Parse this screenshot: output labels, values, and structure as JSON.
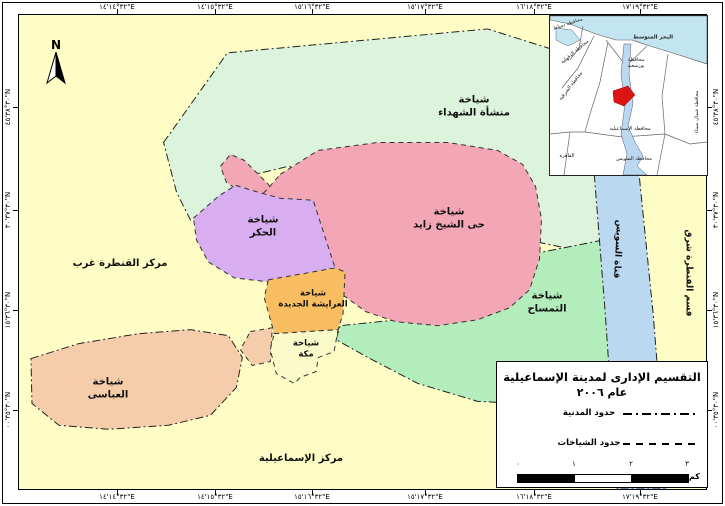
{
  "map_frame": {
    "north_label": "N",
    "coordinates": {
      "top": [
        "٣٢°١٤'١٤\"E",
        "٣٢°١٥'١٤\"E",
        "٣٢°١٦'١٥\"E",
        "٣٢°١٧'١٥\"E",
        "٣٢°١٨'١٦\"E",
        "٣٢°١٩'١٧\"E"
      ],
      "bottom": [
        "٣٢°١٤'١٤\"E",
        "٣٢°١٥'١٤\"E",
        "٣٢°١٦'١٥\"E",
        "٣٢°١٧'١٥\"E",
        "٣٢°١٨'١٦\"E",
        "٣٢°١٩'١٧\"E"
      ],
      "left": [
        "٣٠°٣٨'٤٥\"N",
        "٣٠°٣٧'٣٠\"N",
        "٣٠°٣٦'١٥\"N",
        "٣٠°٣٥'٠٠\"N"
      ],
      "right": [
        "٣٠°٣٨'٤٥\"N",
        "٣٠°٣٧'٣٠\"N",
        "٣٠°٣٦'١٥\"N",
        "٣٠°٣٥'٠٠\"N"
      ]
    }
  },
  "regions": {
    "manshaat_elshohada": "شياخة\nمنشأة الشهداء",
    "sheikh_zayed": "شياخة\nحى الشيخ زايد",
    "elhekr": "شياخة\nالحكر",
    "elaraysha_elgedida": "شياخة\nالعرايشة الجديدة",
    "mekka": "شياخة\nمكة",
    "eltemsah": "شياخة\nالتمساح",
    "elabbasi": "شياخة\nالعباسى",
    "qantara_gharb": "مركز القنطرة غرب",
    "markaz_ismailia": "مركز الإسماعيلية",
    "suez_canal": "قناة السويس",
    "qantara_sharq": "قسم القنطرة شرق"
  },
  "inset": {
    "mediterranean": "البحر المتوسط",
    "damietta": "محافظة دمياط",
    "dakahlia": "محافظة الدقهلية",
    "sharqia": "محافظة الشرقية",
    "port_said": "محافظة\nبورسعيد",
    "north_sinai": "محافظة شمال سيناء",
    "ismailia_gov": "محافظة الإسماعيلية",
    "suez_gov": "محافظة السويس",
    "cairo": "القاهرة"
  },
  "legend": {
    "title": "التقسيم الإدارى لمدينة الإسماعيلية",
    "subtitle": "عام ٢٠٠٦",
    "items": [
      {
        "label": "حدود المدنية",
        "style": "dash-dot"
      },
      {
        "label": "حدود الشياخات",
        "style": "dashed"
      }
    ],
    "scale_ticks": [
      "٠",
      "١",
      "٢",
      "٣"
    ],
    "scale_unit": "كم"
  },
  "colors": {
    "base_yellow": "#FDFDC5",
    "mint_green": "#DCF3DC",
    "pink": "#F3A7B6",
    "purple": "#D8AEF0",
    "orange": "#F9BE62",
    "pale_yellow": "#FBFBC9",
    "green": "#B3EDBC",
    "peach": "#F6CDAB",
    "canal_blue": "#BBD8F1",
    "sea_blue": "#C3E5F2",
    "highlight_red": "#DB1414"
  }
}
